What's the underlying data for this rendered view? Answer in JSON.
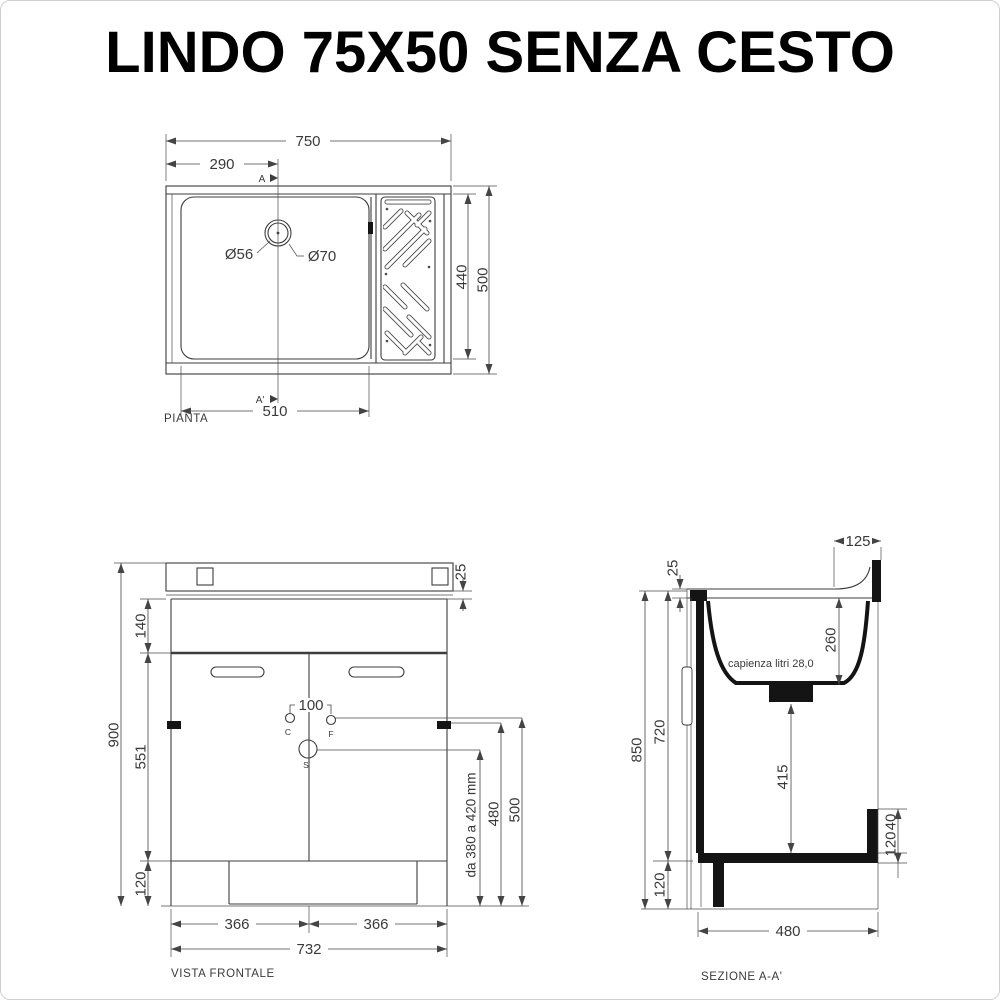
{
  "title": "LINDO 75X50 SENZA CESTO",
  "colors": {
    "line": "#3d3d3d",
    "text": "#3a3a3a",
    "title": "#000000"
  },
  "plan": {
    "label": "PIANTA",
    "dim_total_width": "750",
    "dim_drain_offset": "290",
    "dim_basin_width": "510",
    "dim_inner_depth": "440",
    "dim_total_depth": "500",
    "dim_drain_inner": "Ø56",
    "dim_drain_outer": "Ø70",
    "section_mark_top": "A",
    "section_mark_bottom": "A'"
  },
  "front": {
    "label": "VISTA FRONTALE",
    "dim_total_height": "900",
    "dim_top_band": "140",
    "dim_door_height": "551",
    "dim_plinth_height": "120",
    "dim_top_edge": "25",
    "dim_tap_spacing": "100",
    "mark_hot": "C",
    "mark_cold": "F",
    "mark_drain": "S",
    "dim_drain_range": "da 380 a 420 mm",
    "dim_side_fix_height": "480",
    "dim_tap_height": "500",
    "dim_door_width_left": "366",
    "dim_door_width_right": "366",
    "dim_total_width": "732"
  },
  "section": {
    "label": "SEZIONE A-A'",
    "capacity_note": "capienza litri 28,0",
    "dim_top_edge": "25",
    "dim_splash_overhang": "125",
    "dim_basin_depth": "260",
    "dim_total_height": "850",
    "dim_inner_height": "720",
    "dim_plinth_height": "120",
    "dim_drain_clearance": "415",
    "dim_step_thickness": "40",
    "dim_step_height": "120",
    "dim_total_depth": "480"
  }
}
